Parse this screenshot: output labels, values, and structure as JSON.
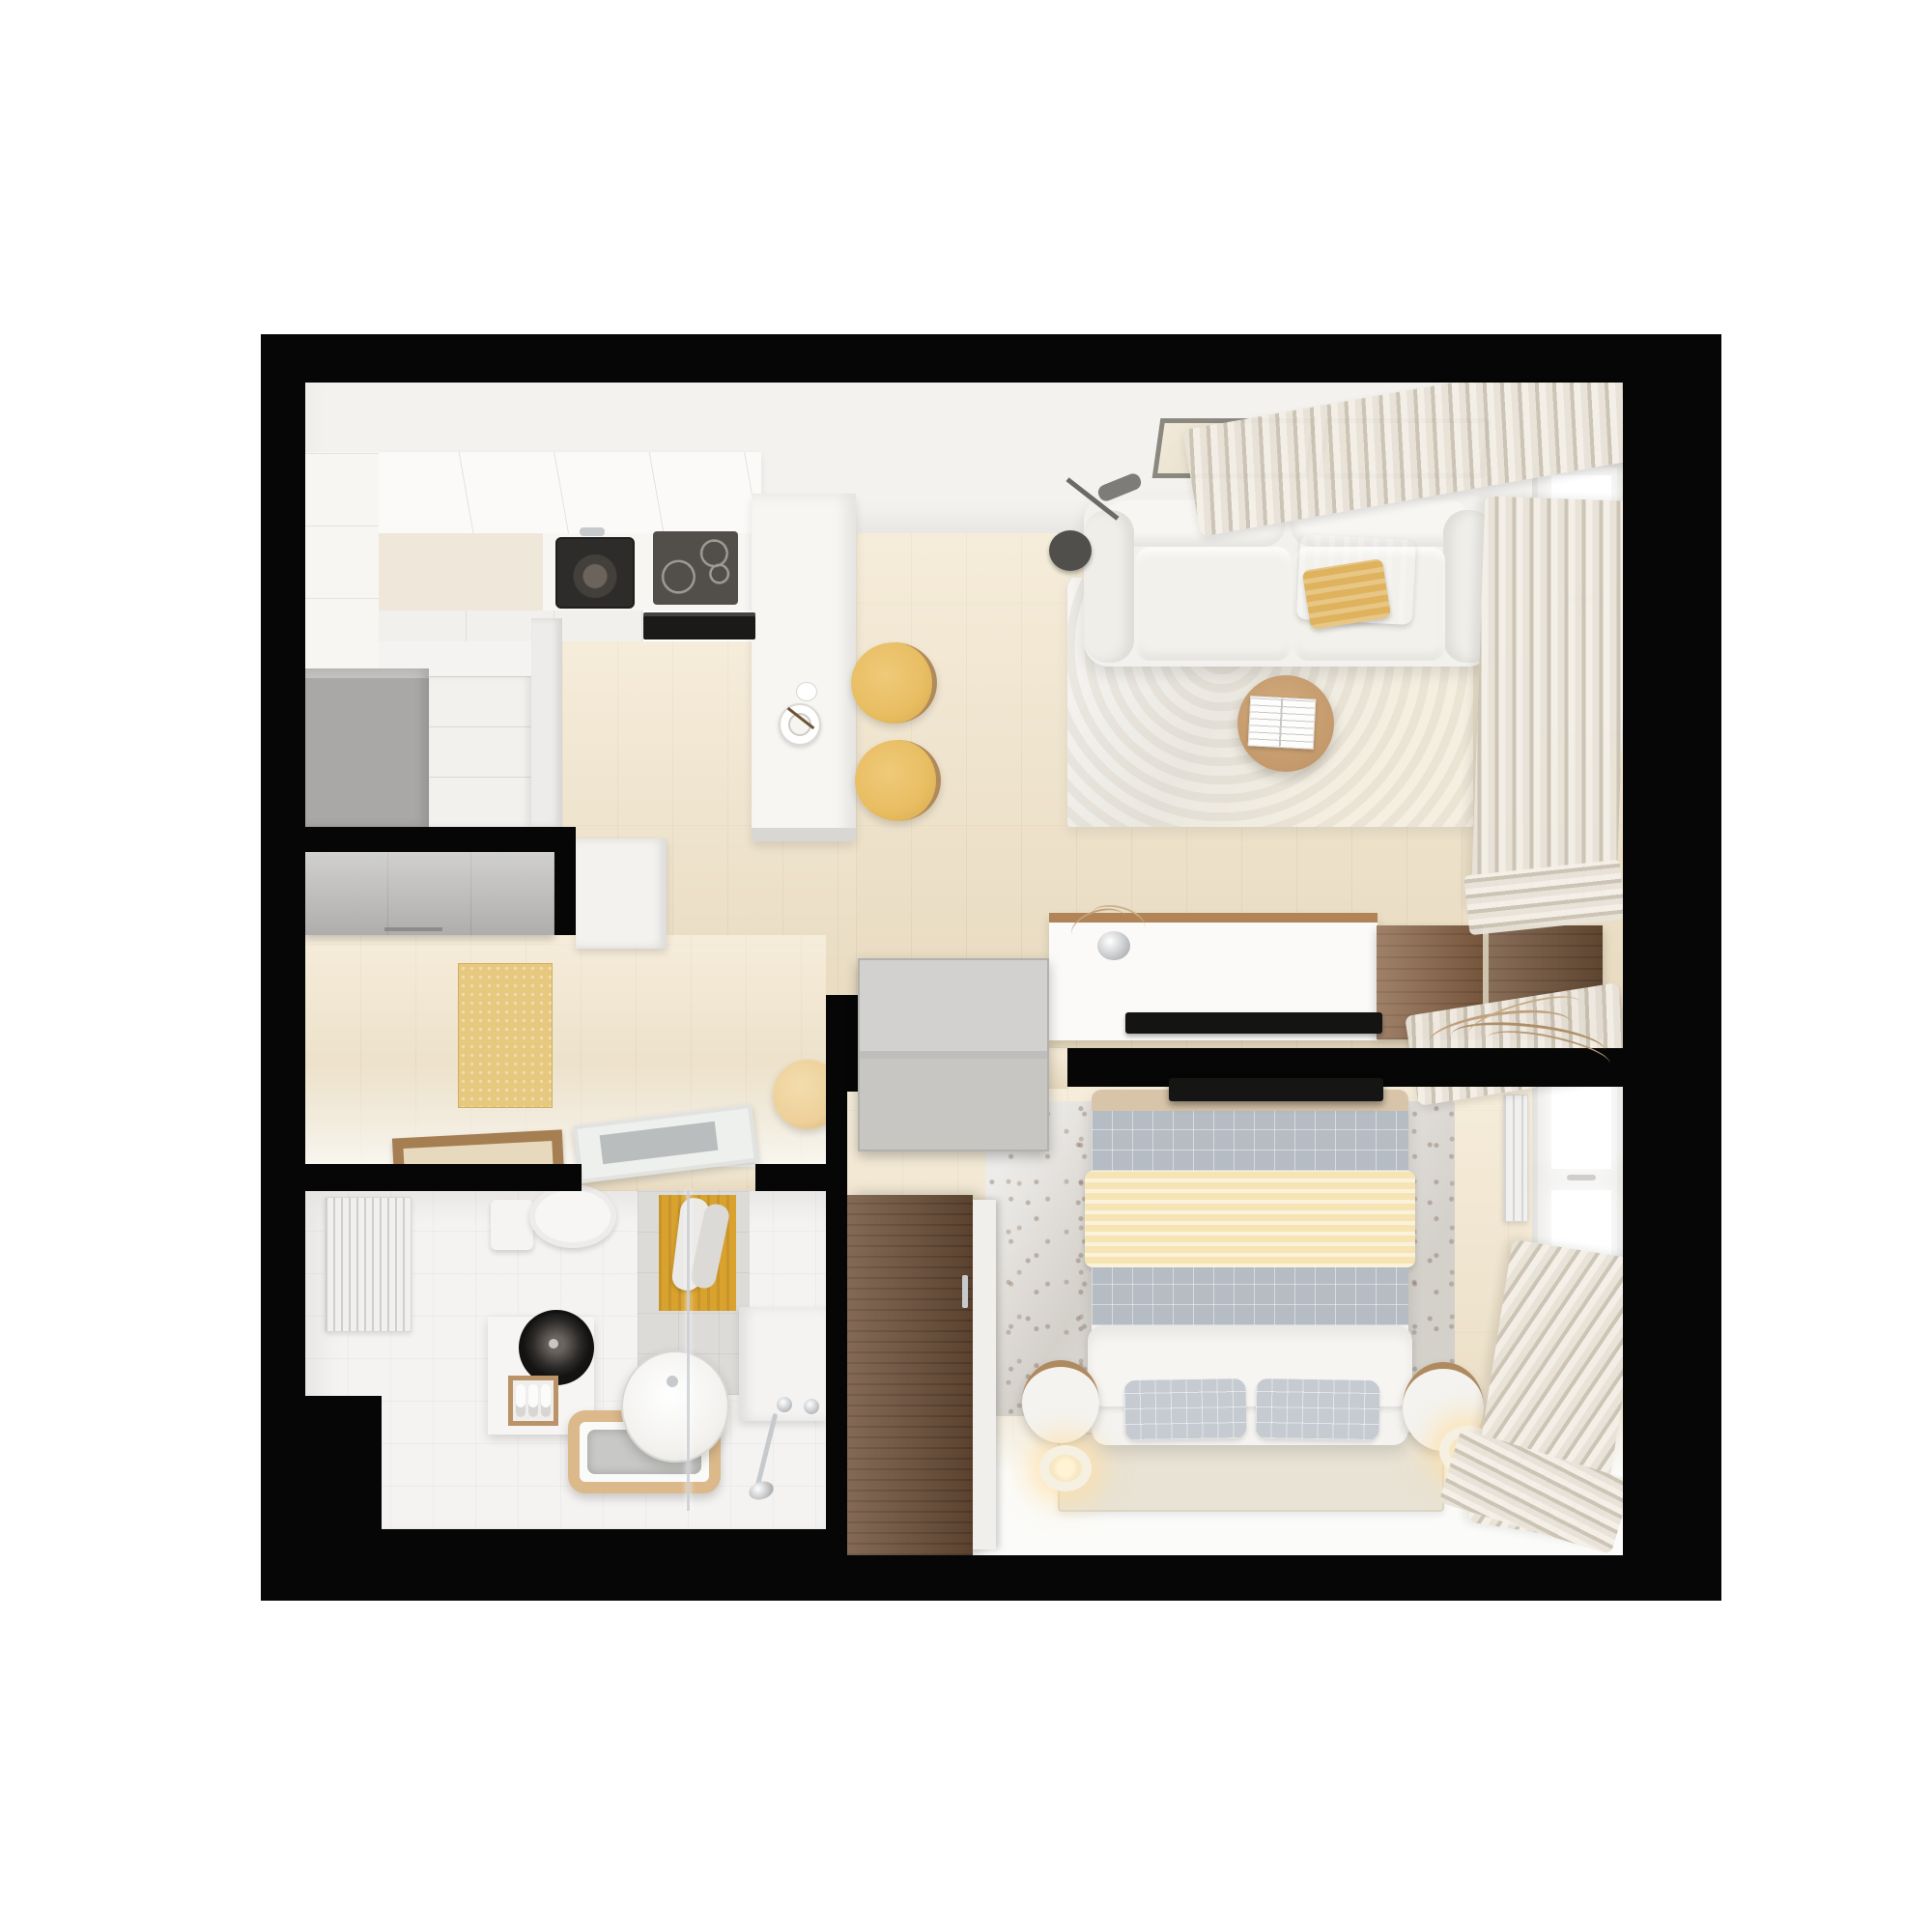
{
  "title": "Studio apartment 3D floor plan - top-down render",
  "palette": {
    "bg": "#ffffff",
    "wall": "#060606",
    "wood_light": "#f0e2c6",
    "floor_white": "#f4f3f1",
    "room_white": "#f3f2ef",
    "counter": "#f7f6f3",
    "cabinet_white": "#f1f0ed",
    "cabinet_gray": "#a9a8a6",
    "closet_gray": "#b8b7b5",
    "sink_black": "#2e2c2a",
    "cooktop": "#524f4b",
    "oven": "#1b1a19",
    "steel": "#c7cacd",
    "yellow_stool": "#e8bd62",
    "yellow_mat": "#e6c87f",
    "yellow_towel": "#d9a22e",
    "yellow_throw": "#e9c270",
    "cream_blanket": "#f6e4b5",
    "sofa": "#f2f1ed",
    "rug_living": "#ebe8e1",
    "rug_bed": "#d4d0ca",
    "plaid": "#b6bcc4",
    "plaid_light": "#c6cbd1",
    "duvet": "#f4f3f0",
    "mat_beige": "#e9e3d5",
    "table_wood": "#c49a6c",
    "console_wood": "#b08456",
    "dresser_wood": "#8a6547",
    "dresser_dark": "#75563c",
    "wardrobe": "#6f5139",
    "tub_wood": "#dbb98b",
    "frame_wood": "#a57e52",
    "art_frame": "#8b8880",
    "curtain_a": "#e8e2d8",
    "curtain_b": "#cbc3b4",
    "door_gray": "#c7c6c3",
    "glass_gray": "#b9bdbd",
    "radiator": "#f1f0ee",
    "tan_bar": "#d8c5a9",
    "pouf": "#edd09a"
  },
  "scene": {
    "type": "apartment-floor-plan-top-view",
    "rooms": [
      {
        "name": "kitchen",
        "position": "top-left",
        "items": [
          "upper-cabinets",
          "kitchen-sink",
          "induction-cooktop",
          "built-in-oven",
          "gray-tall-unit",
          "drawer-unit",
          "counter-peninsula",
          "espresso-cup",
          "bar-stool",
          "bar-stool"
        ]
      },
      {
        "name": "living-room",
        "position": "top-right",
        "items": [
          "wall-art-frame",
          "wall-art-frame",
          "floor-lamp",
          "three-seat-sofa",
          "yellow-throw-blanket",
          "area-rug",
          "round-coffee-table",
          "open-book",
          "tv-console",
          "television",
          "flower-vase",
          "wood-dresser",
          "wood-dresser",
          "radiator",
          "window",
          "curtains"
        ]
      },
      {
        "name": "hallway",
        "position": "middle-left",
        "items": [
          "entry-closet",
          "white-cabinet",
          "yellow-doormat",
          "floor-mirror-frame",
          "open-door-leaf",
          "round-pouf"
        ]
      },
      {
        "name": "bathroom",
        "position": "bottom-left",
        "items": [
          "radiator",
          "toilet",
          "yellow-hand-towel",
          "shower-glass-screen",
          "vanity-cube",
          "black-round-sink",
          "towel-niche",
          "freestanding-basin",
          "wood-framed-bathtub",
          "chrome-shower-set",
          "white-bench"
        ]
      },
      {
        "name": "bedroom",
        "position": "bottom-right",
        "items": [
          "double-bed",
          "cream-blanket",
          "plaid-bedding",
          "pillow",
          "pillow",
          "drum-nightstand",
          "drum-nightstand",
          "ring-lamp",
          "ring-lamp",
          "bedside-rug",
          "beige-mat",
          "wardrobe",
          "open-wardrobe-door",
          "wall-tv",
          "dried-branch-decor",
          "radiator",
          "window",
          "curtains",
          "open-door-leaf"
        ]
      }
    ]
  }
}
